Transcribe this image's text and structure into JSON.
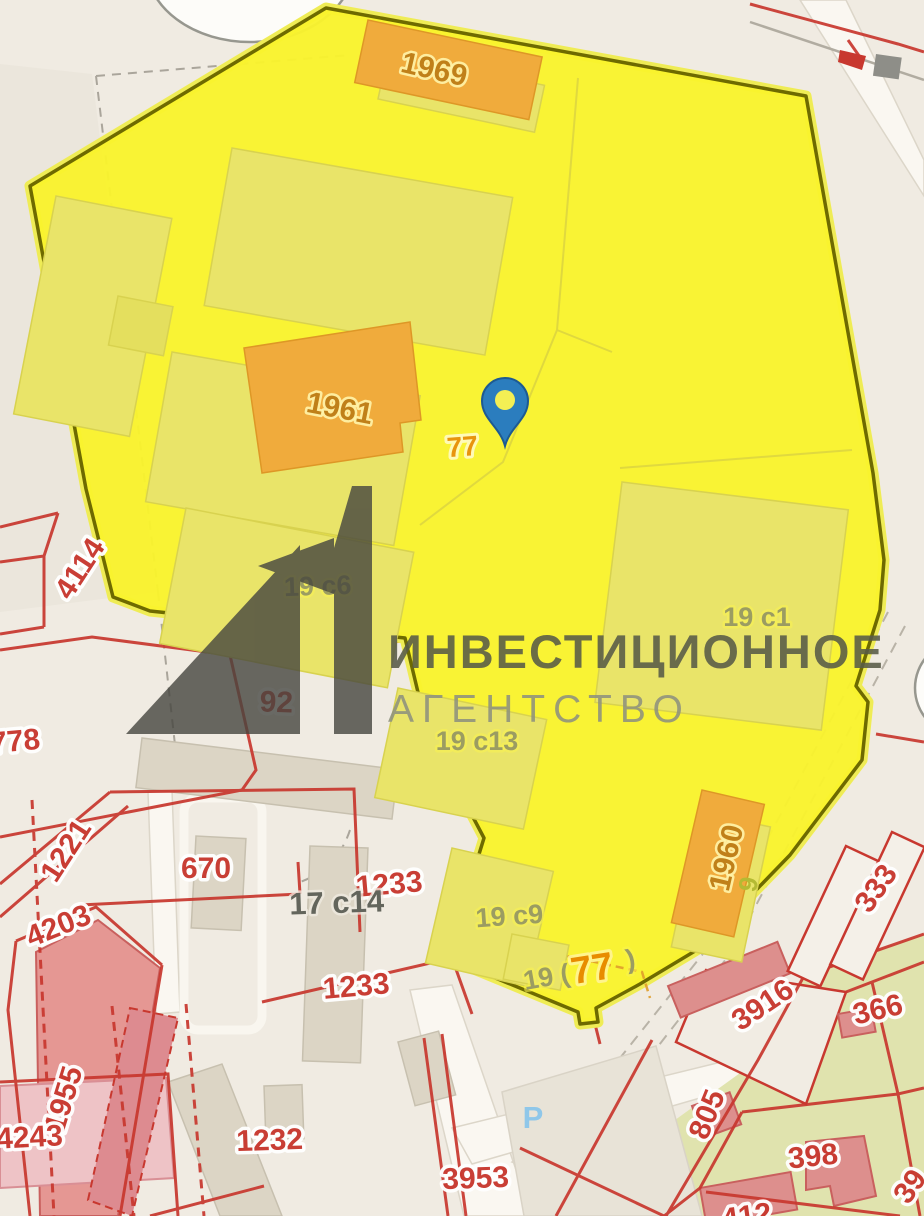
{
  "watermark": {
    "logo_mark": "a1-logo",
    "line1": "ИНВЕСТИЦИОННОЕ",
    "line2": "АГЕНТСТВО"
  },
  "parcel": {
    "address_label_main": "77",
    "address_label_south": "77",
    "orange_buildings": [
      {
        "number": "1969"
      },
      {
        "number": "1961"
      },
      {
        "number": "1960"
      }
    ],
    "structures": [
      {
        "number": "19 с6"
      },
      {
        "number": "19 с1"
      },
      {
        "number": "19 с13"
      },
      {
        "number": "19 с9"
      },
      {
        "number": "19 ("
      },
      {
        "number": ")"
      },
      {
        "number": "9"
      }
    ]
  },
  "cadastral_numbers": [
    {
      "text": "4114"
    },
    {
      "text": "778"
    },
    {
      "text": "92"
    },
    {
      "text": "1221"
    },
    {
      "text": "670"
    },
    {
      "text": "4203"
    },
    {
      "text": "1233"
    },
    {
      "text": "1233"
    },
    {
      "text": "1955"
    },
    {
      "text": "4243"
    },
    {
      "text": "1232"
    },
    {
      "text": "3953"
    },
    {
      "text": "3916"
    },
    {
      "text": "366"
    },
    {
      "text": "333"
    },
    {
      "text": "805"
    },
    {
      "text": "398"
    },
    {
      "text": "39"
    },
    {
      "text": "412"
    }
  ],
  "other_labels": {
    "building_17": "17 с14",
    "parking": "P"
  },
  "icons": {
    "pin": "location-pin",
    "parking": "parking-icon"
  },
  "colors": {
    "background": "#f0ebe2",
    "parcel_fill": "#f9f32d",
    "parcel_border": "#6e6a00",
    "building_orange": "#f0ab3c",
    "building_pale": "#e9e469",
    "building_gray": "#dcd5c5",
    "building_pink": "#e0908f",
    "parcel_green": "#e0e3ae",
    "cadastral_red": "#c8382f",
    "label_olive": "#9b9c62",
    "pin_blue": "#2b7dbe",
    "parking_blue": "#8fc7e9",
    "watermark_dark": "#45453f"
  }
}
